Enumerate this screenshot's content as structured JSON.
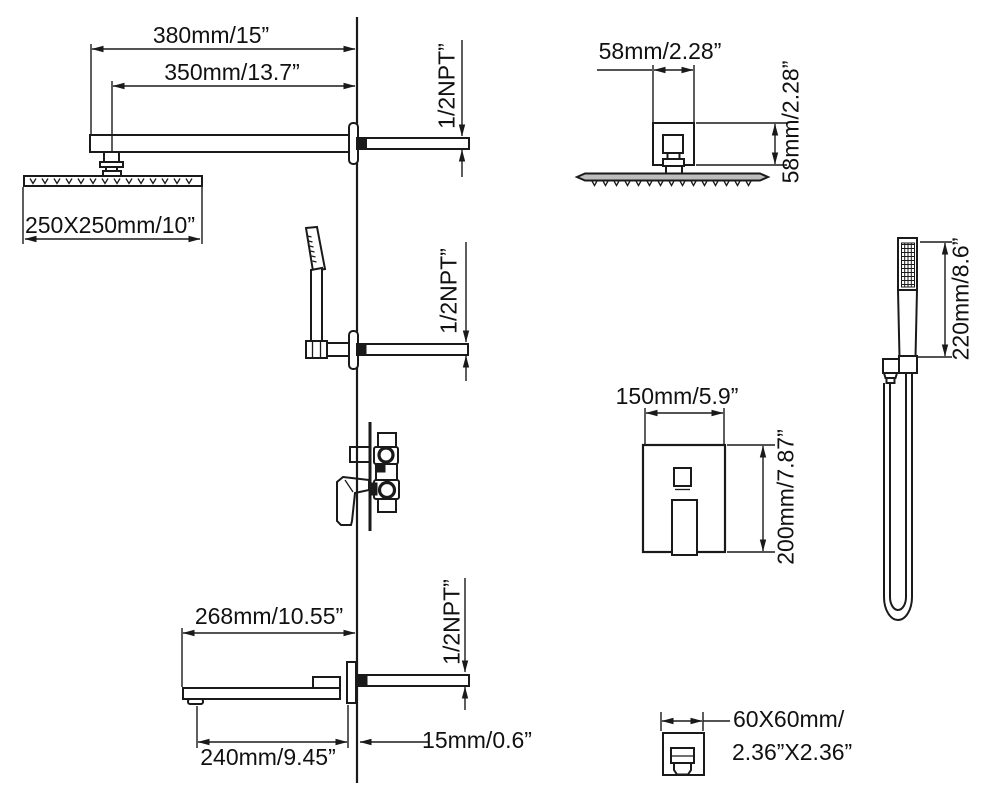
{
  "labels": {
    "rain_arm": {
      "overall": "380mm/15”",
      "to_head": "350mm/13.7”",
      "head_size": "250X250mm/10”",
      "thread": "1/2NPT”"
    },
    "head_top_view": {
      "width": "58mm/2.28”",
      "height": "58mm/2.28”"
    },
    "holder": {
      "thread": "1/2NPT”"
    },
    "valve_plate": {
      "width": "150mm/5.9”",
      "height": "200mm/7.87”"
    },
    "hand_shower": {
      "length": "220mm/8.6”"
    },
    "spout": {
      "overall": "268mm/10.55”",
      "body": "240mm/9.45”",
      "wall_offset": "15mm/0.6”",
      "thread": "1/2NPT”"
    },
    "spout_face": {
      "size_mm": "60X60mm/",
      "size_in": "2.36”X2.36”"
    }
  },
  "colors": {
    "line": "#1a1a1a",
    "background": "#ffffff",
    "head_fill": "#bdbdbd"
  }
}
